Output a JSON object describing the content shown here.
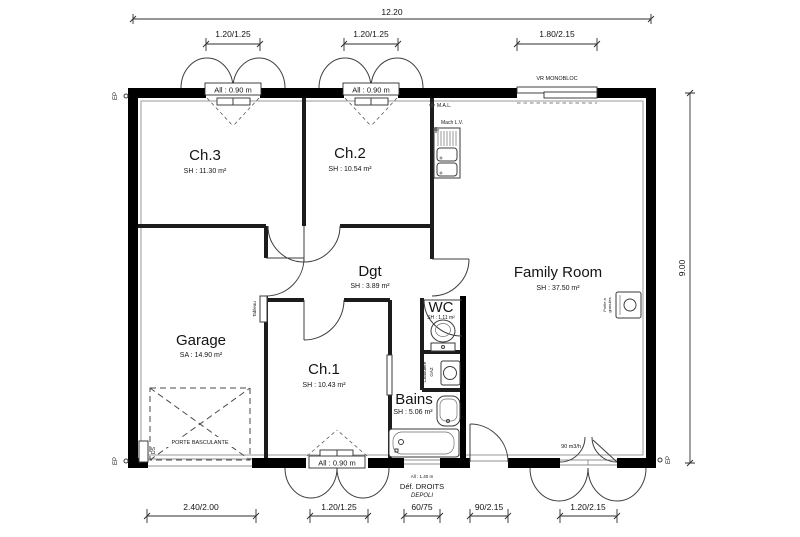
{
  "dims": {
    "top_total": "12.20",
    "top_seg1": "1.20/1.25",
    "top_seg2": "1.20/1.25",
    "top_seg3": "1.80/2.15",
    "right_total": "9.00",
    "bottom_seg1": "2.40/2.00",
    "bottom_seg2": "1.20/1.25",
    "bottom_seg3": "60/75",
    "bottom_seg4": "90/2.15",
    "bottom_seg5": "1.20/2.15"
  },
  "rooms": {
    "ch3": {
      "name": "Ch.3",
      "area": "SH : 11.30 m²"
    },
    "ch2": {
      "name": "Ch.2",
      "area": "SH : 10.54 m²"
    },
    "ch1": {
      "name": "Ch.1",
      "area": "SH : 10.43 m²"
    },
    "family": {
      "name": "Family Room",
      "area": "SH : 37.50 m²"
    },
    "dgt": {
      "name": "Dgt",
      "area": "SH : 3.89 m²"
    },
    "wc": {
      "name": "WC",
      "area": "SH : 1.11 m²"
    },
    "bains": {
      "name": "Bains",
      "area": "SH : 5.06 m²"
    },
    "garage": {
      "name": "Garage",
      "area": "SA : 14.90 m²"
    }
  },
  "labels": {
    "sill_090": "All : 0.90 m",
    "sill_140": "All : 1.40 m",
    "def_droits": "Déf. DROITS",
    "depoli": "DEPOLI",
    "vr_monobloc": "VR MONOBLOC",
    "mal": "M.A.L.",
    "mach_lv": "Mach L.V.",
    "tableau": "Tableau",
    "chaudiere_line1": "Chaudière",
    "chaudiere_line2": "GAZ",
    "poele_line1": "Poêle à",
    "poele_line2": "granulés",
    "porte_basculante": "PORTE BASCULANTE",
    "ds": "DS",
    "ep": "EP",
    "vent": "90 m3/h"
  },
  "colors": {
    "wall": "#000000",
    "line": "#3d3d3d",
    "background": "#ffffff"
  }
}
